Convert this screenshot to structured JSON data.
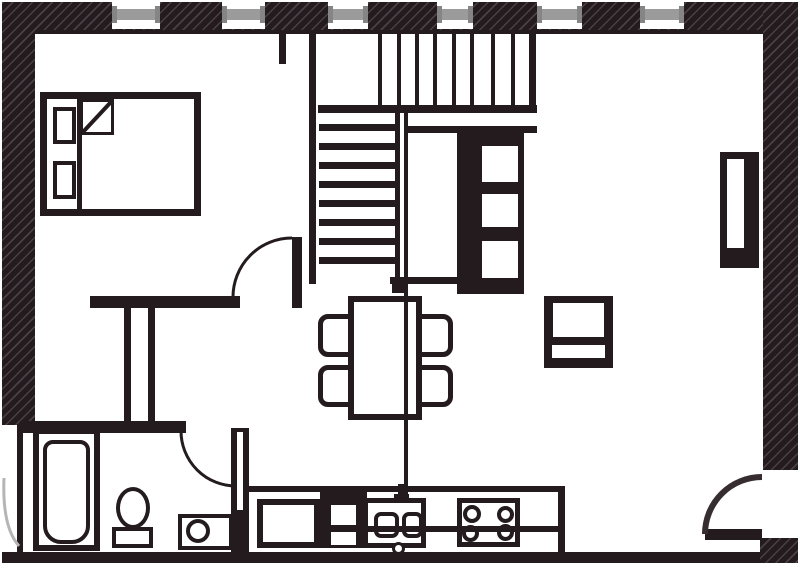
{
  "title": "apartment-floor-plan",
  "canvas": {
    "width": 800,
    "height": 569
  },
  "colors": {
    "ink": "#231b1e",
    "hatch_light": "#4a4046",
    "paper": "#ffffff",
    "window_glass": "#9b9b9b",
    "window_cap": "#858585",
    "door_swing_gray": "#b5b5b5"
  },
  "inventory": {
    "windows_on_top_wall": 6,
    "doors": [
      "bedroom-door",
      "bathroom-door",
      "entry-door-bottom-right",
      "left-wall-door-swing"
    ],
    "stairs": {
      "lower_flight_treads": 8,
      "upper_flight_risers": 8,
      "shape": "L-shaped"
    },
    "bedroom": [
      "double-bed",
      "two-pillows",
      "folded-blanket-corner"
    ],
    "living_area": [
      "dining-table",
      "four-chairs",
      "tall-shelf-unit",
      "side-table",
      "wall-radiator"
    ],
    "kitchen": [
      "base-cabinet",
      "oven-unit-two-drawers",
      "double-basin-sink",
      "faucet",
      "four-burner-hob",
      "counter"
    ],
    "bathroom": [
      "bathtub",
      "toilet",
      "wash-basin"
    ]
  }
}
